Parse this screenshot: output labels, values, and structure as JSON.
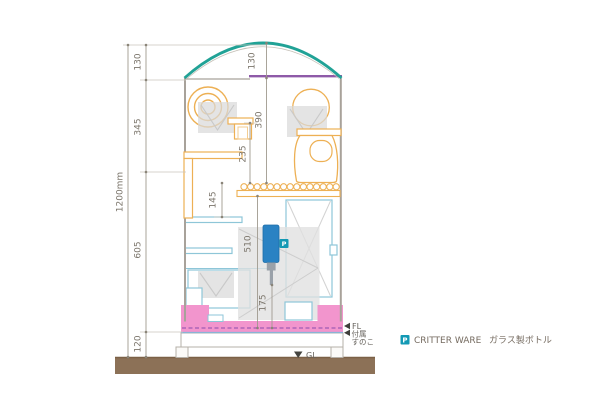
{
  "drawing": {
    "overall_height_label": "1200mm",
    "left_dims": {
      "roof": "130",
      "upper": "345",
      "lower": "605",
      "base": "120"
    },
    "inner_dims": {
      "roof_rise": "130",
      "upper_right_height": "390",
      "upper_center_height": "235",
      "mid_shelf_drop": "145",
      "lower_height": "510",
      "bottle_tip_height": "175"
    },
    "level_markers": {
      "floor": "FL",
      "slat_line1": "付属",
      "slat_line2": "すのこ",
      "ground": "GL"
    },
    "bottle": {
      "badge": "P"
    },
    "legend": {
      "badge": "P",
      "brand": "CRITTER WARE",
      "item": "ガラス製ボトル"
    },
    "colors": {
      "roof_teal": "#21a296",
      "top_purple": "#8e5aa8",
      "accessory_orange": "#edb054",
      "shelf_cyan": "#8ec6d8",
      "bottle_blue": "#2a82c3",
      "badge_teal": "#1399b4",
      "tray_pink": "#f295cd",
      "ground_brown": "#8c7157"
    }
  }
}
